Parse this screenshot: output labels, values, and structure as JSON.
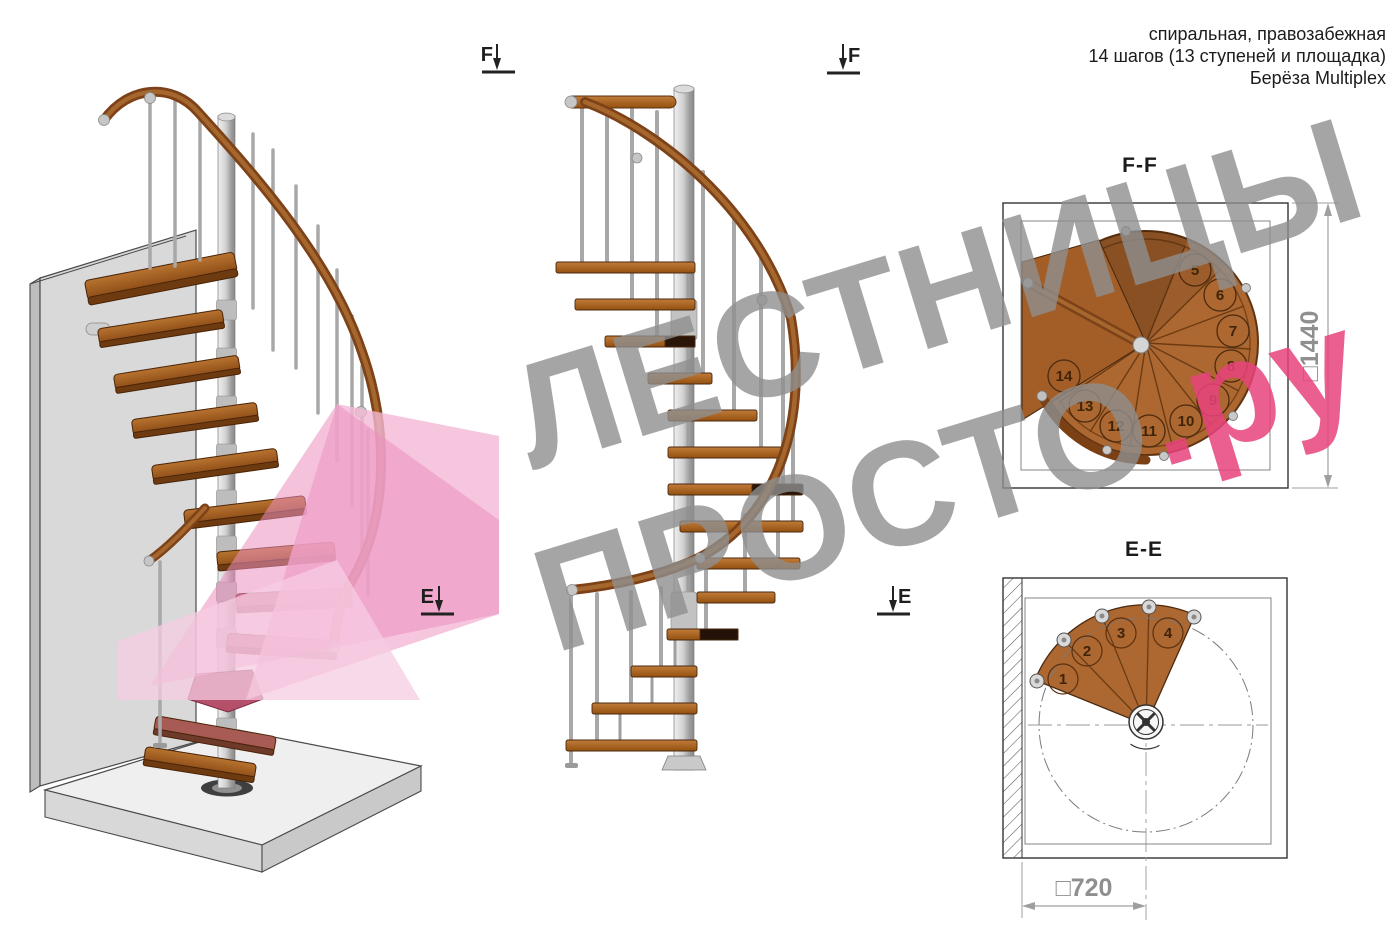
{
  "header": {
    "line1": "спиральная, правозабежная",
    "line2": "14 шагов (13 ступеней и площадка)",
    "line3": "Берёза Multiplex"
  },
  "watermark": {
    "word1": "ЛЕСТНИЦЫ",
    "word2": "ПРОСТО",
    "word2_suffix": ".ру"
  },
  "markers": {
    "f": "F",
    "e": "E"
  },
  "ff": {
    "title": "F-F",
    "dim": "□1440",
    "steps": [
      "5",
      "6",
      "7",
      "8",
      "9",
      "10",
      "11",
      "12",
      "13",
      "14"
    ]
  },
  "ee": {
    "title": "E-E",
    "dim": "□720",
    "steps": [
      "1",
      "2",
      "3",
      "4"
    ]
  },
  "colors": {
    "wood": "#b06a32",
    "wood_dark": "#8a4a1e",
    "handrail": "#7d4218",
    "accent_pink": "#e8437c",
    "plane_pink": "#f2aed2",
    "crimson_step": "#b5506b",
    "watermark_gray": "#8f8f8f",
    "dim_gray": "#8f8f8f",
    "pole_silver": "#c9c9c9"
  }
}
